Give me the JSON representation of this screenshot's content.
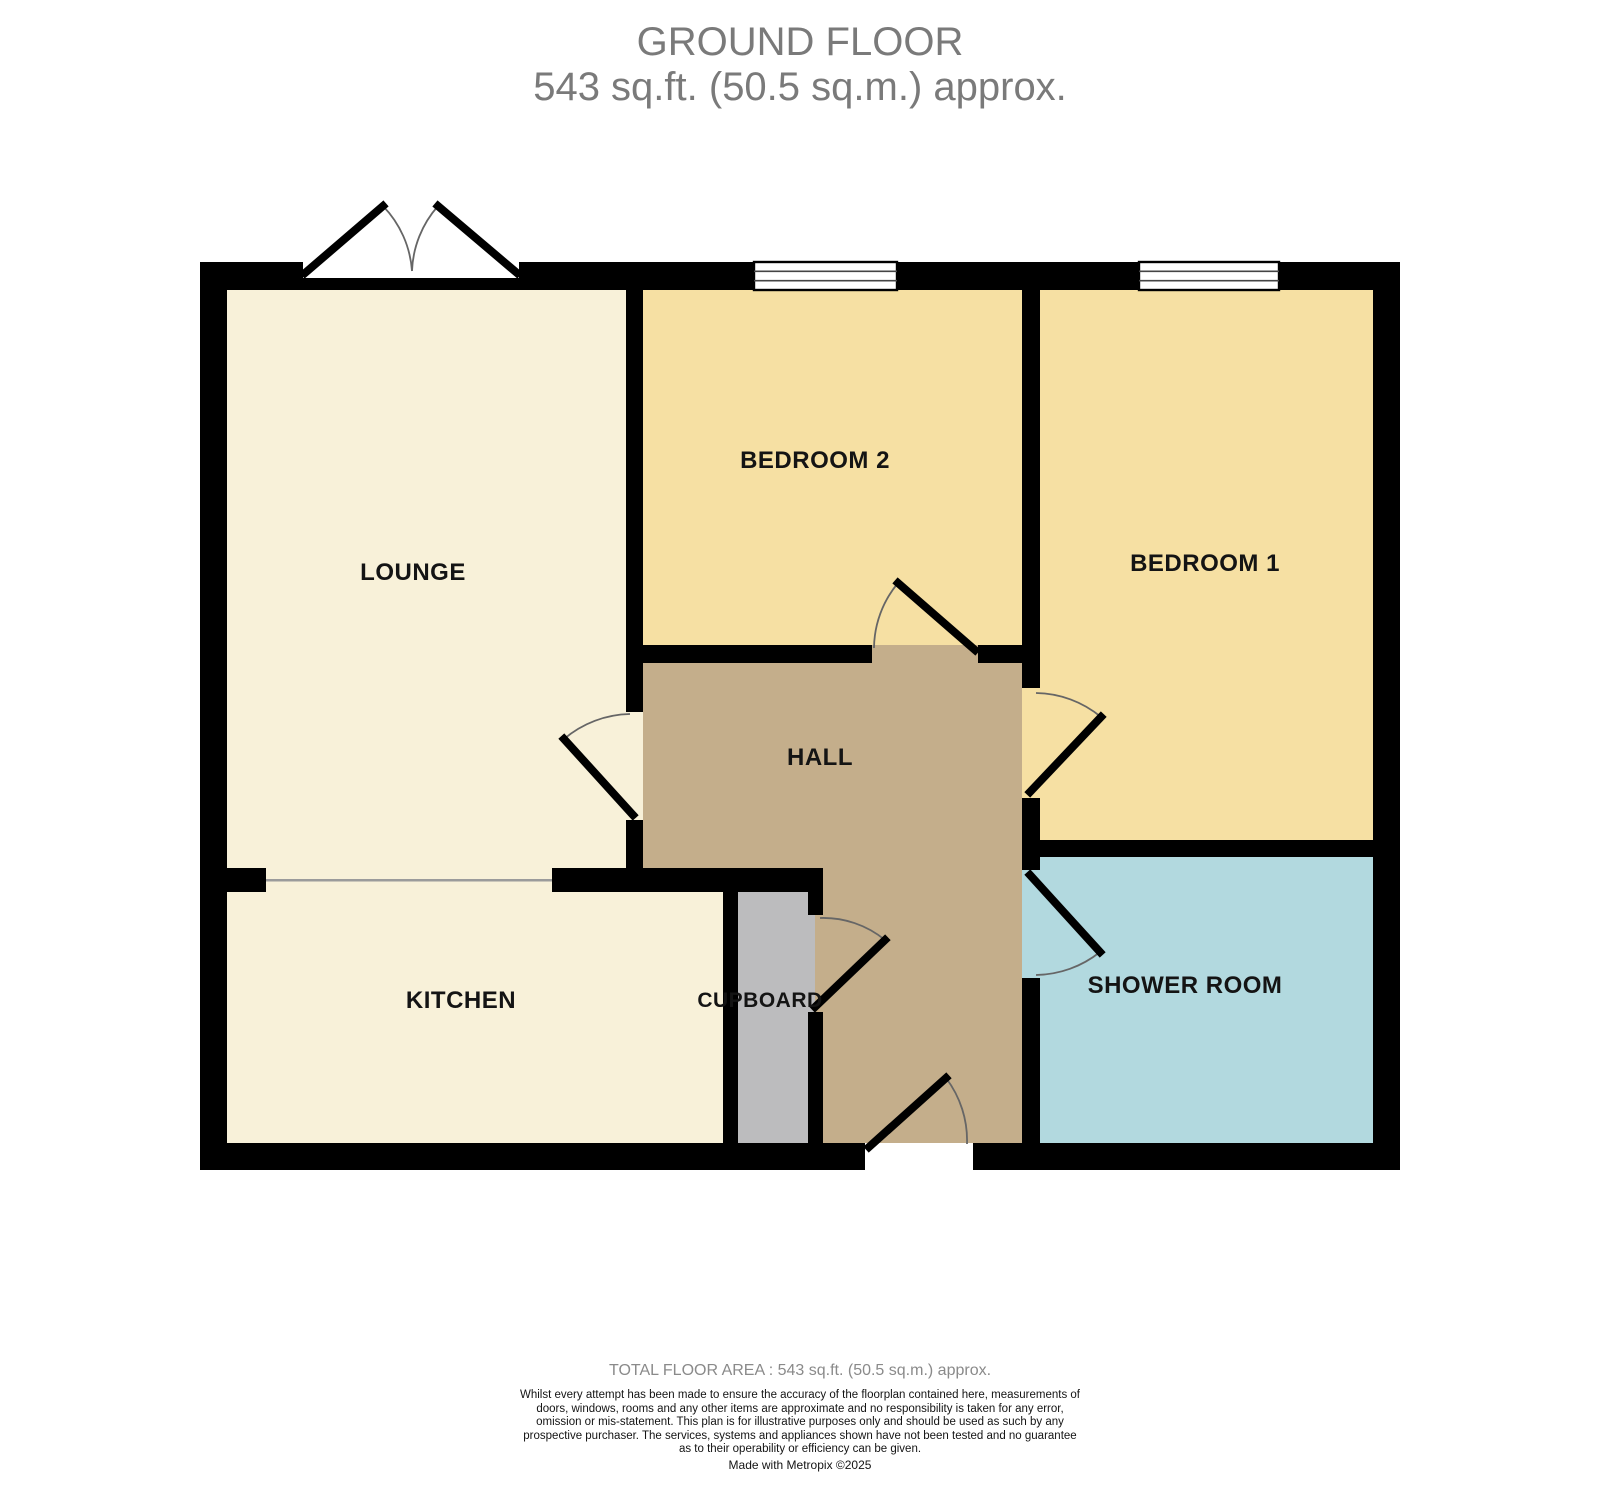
{
  "title": {
    "line1": "GROUND FLOOR",
    "line2": "543 sq.ft. (50.5 sq.m.) approx."
  },
  "rooms": {
    "lounge": {
      "label": "LOUNGE",
      "color": "#F8F1D9"
    },
    "bedroom2": {
      "label": "BEDROOM 2",
      "color": "#F6E0A3"
    },
    "bedroom1": {
      "label": "BEDROOM 1",
      "color": "#F6E0A3"
    },
    "hall": {
      "label": "HALL",
      "color": "#C4AE8B"
    },
    "kitchen": {
      "label": "KITCHEN",
      "color": "#F8F1D9"
    },
    "cupboard": {
      "label": "CUPBOARD",
      "color": "#BCBCBE"
    },
    "shower_room": {
      "label": "SHOWER ROOM",
      "color": "#B2D9DF"
    }
  },
  "colors": {
    "wall": "#000000",
    "divider_line": "#9B9B9B",
    "door_arc": "#666666",
    "title_text": "#7A7A7A",
    "total_area_text": "#8A8A8A"
  },
  "footer": {
    "total_area": "TOTAL FLOOR AREA : 543 sq.ft. (50.5 sq.m.) approx.",
    "disclaimer": "Whilst every attempt has been made to ensure the accuracy of the floorplan contained here, measurements of doors, windows, rooms and any other items are approximate and no responsibility is taken for any error, omission or mis-statement. This plan is for illustrative purposes only and should be used as such by any prospective purchaser. The services, systems and appliances shown have not been tested and no guarantee as to their operability or efficiency can be given.",
    "credit": "Made with Metropix ©2025"
  }
}
